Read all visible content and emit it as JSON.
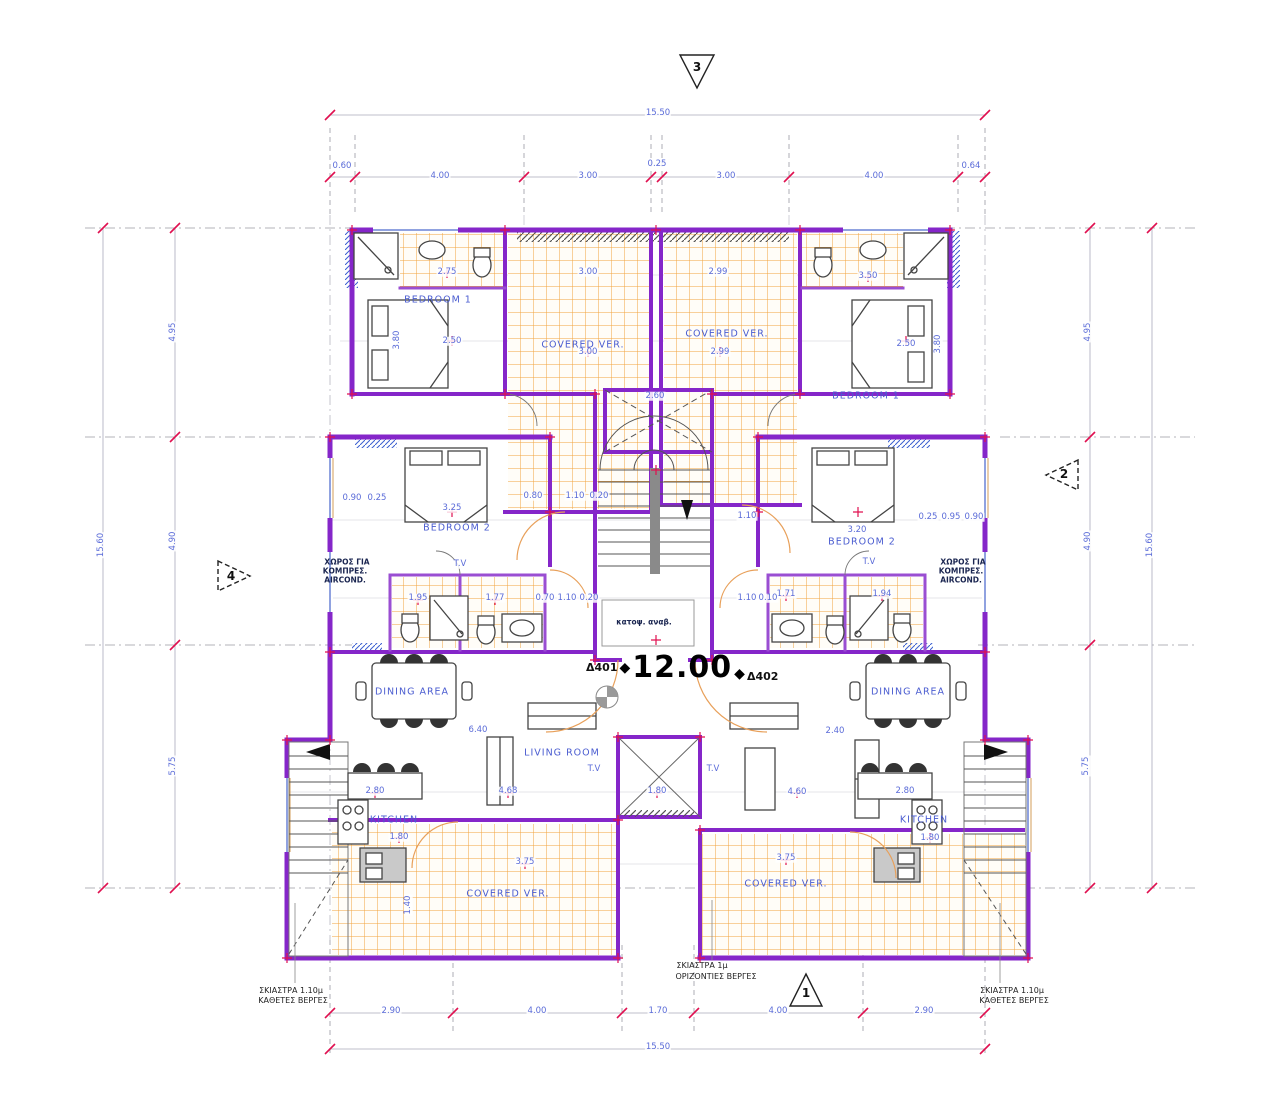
{
  "level": {
    "left": "Δ401",
    "value": "12.00",
    "right": "Δ402"
  },
  "markers": [
    {
      "id": "3",
      "position": "top"
    },
    {
      "id": "1",
      "position": "bottom"
    },
    {
      "id": "2",
      "position": "right"
    },
    {
      "id": "4",
      "position": "left"
    }
  ],
  "dimension_chains": {
    "top": {
      "overall": "15.50",
      "segments": [
        "0.60",
        "4.00",
        "3.00",
        "0.25",
        "3.00",
        "4.00",
        "0.64"
      ]
    },
    "bottom": {
      "overall": "15.50",
      "segments": [
        "2.90",
        "4.00",
        "1.70",
        "4.00",
        "2.90"
      ]
    },
    "left": {
      "overall": "15.60",
      "segments": [
        "4.95",
        "4.90",
        "5.75"
      ]
    },
    "right": {
      "overall": "15.60",
      "segments": [
        "4.95",
        "4.90",
        "5.75"
      ]
    }
  },
  "colors": {
    "wall": "#8526c9",
    "tile": "#f2a43e",
    "dim_text": "#5a6bd8",
    "tick": "#e01050"
  },
  "labels": [
    {
      "t": "15.50",
      "x": 658,
      "y": 113,
      "n": "dim-top-overall"
    },
    {
      "t": "0.60",
      "x": 342,
      "y": 166
    },
    {
      "t": "4.00",
      "x": 440,
      "y": 176
    },
    {
      "t": "3.00",
      "x": 588,
      "y": 176
    },
    {
      "t": "0.25",
      "x": 657,
      "y": 164
    },
    {
      "t": "3.00",
      "x": 726,
      "y": 176
    },
    {
      "t": "4.00",
      "x": 874,
      "y": 176
    },
    {
      "t": "0.64",
      "x": 971,
      "y": 166
    },
    {
      "t": "2.90",
      "x": 391,
      "y": 1011
    },
    {
      "t": "4.00",
      "x": 537,
      "y": 1011
    },
    {
      "t": "1.70",
      "x": 658,
      "y": 1011
    },
    {
      "t": "4.00",
      "x": 778,
      "y": 1011
    },
    {
      "t": "2.90",
      "x": 924,
      "y": 1011
    },
    {
      "t": "15.50",
      "x": 658,
      "y": 1047,
      "n": "dim-bottom-overall"
    },
    {
      "t": "15.60",
      "x": 101,
      "y": 545,
      "r": 1,
      "n": "dim-left-overall"
    },
    {
      "t": "4.95",
      "x": 173,
      "y": 332,
      "r": 1
    },
    {
      "t": "4.90",
      "x": 173,
      "y": 541,
      "r": 1
    },
    {
      "t": "5.75",
      "x": 173,
      "y": 766,
      "r": 1
    },
    {
      "t": "4.95",
      "x": 1088,
      "y": 332,
      "r": 1
    },
    {
      "t": "4.90",
      "x": 1088,
      "y": 541,
      "r": 1
    },
    {
      "t": "5.75",
      "x": 1086,
      "y": 766,
      "r": 1
    },
    {
      "t": "15.60",
      "x": 1150,
      "y": 545,
      "r": 1,
      "n": "dim-right-overall"
    },
    {
      "t": "3",
      "x": 697,
      "y": 67,
      "c": "mk",
      "n": "section-marker-3-label"
    },
    {
      "t": "1",
      "x": 806,
      "y": 993,
      "c": "mk",
      "n": "section-marker-1-label"
    },
    {
      "t": "2",
      "x": 1064,
      "y": 474,
      "c": "mk",
      "n": "section-marker-2-label"
    },
    {
      "t": "4",
      "x": 231,
      "y": 576,
      "c": "mk",
      "n": "section-marker-4-label"
    },
    {
      "t": "BEDROOM 1",
      "x": 438,
      "y": 300,
      "c": "room",
      "n": "room-label-bedroom1-left"
    },
    {
      "t": "BEDROOM 1",
      "x": 866,
      "y": 396,
      "c": "room",
      "n": "room-label-bedroom1-right"
    },
    {
      "t": "COVERED VER.",
      "x": 583,
      "y": 345,
      "c": "room",
      "n": "room-label-covered-ver-top-left"
    },
    {
      "t": "COVERED VER.",
      "x": 727,
      "y": 334,
      "c": "room",
      "n": "room-label-covered-ver-top-right"
    },
    {
      "t": "BEDROOM 2",
      "x": 457,
      "y": 528,
      "c": "room",
      "n": "room-label-bedroom2-left"
    },
    {
      "t": "BEDROOM 2",
      "x": 862,
      "y": 542,
      "c": "room",
      "n": "room-label-bedroom2-right"
    },
    {
      "t": "DINING AREA",
      "x": 412,
      "y": 692,
      "c": "room",
      "n": "room-label-dining-left"
    },
    {
      "t": "DINING AREA",
      "x": 908,
      "y": 692,
      "c": "room",
      "n": "room-label-dining-right"
    },
    {
      "t": "LIVING ROOM",
      "x": 562,
      "y": 753,
      "c": "room",
      "n": "room-label-living"
    },
    {
      "t": "KITCHEN",
      "x": 394,
      "y": 820,
      "c": "room",
      "n": "room-label-kitchen-left"
    },
    {
      "t": "KITCHEN",
      "x": 924,
      "y": 820,
      "c": "room",
      "n": "room-label-kitchen-right"
    },
    {
      "t": "COVERED VER.",
      "x": 508,
      "y": 894,
      "c": "room",
      "n": "room-label-covered-ver-bottom-left"
    },
    {
      "t": "COVERED VER.",
      "x": 786,
      "y": 884,
      "c": "room",
      "n": "room-label-covered-ver-bottom-right"
    },
    {
      "t": "T.V",
      "x": 460,
      "y": 564
    },
    {
      "t": "T.V",
      "x": 869,
      "y": 562
    },
    {
      "t": "T.V",
      "x": 594,
      "y": 769
    },
    {
      "t": "T.V",
      "x": 713,
      "y": 769
    },
    {
      "t": "κατοψ. αναβ.",
      "x": 644,
      "y": 622,
      "c": "grk",
      "n": "stair-lobby-note"
    },
    {
      "t": "ΧΩΡΟΣ ΓΙΑ",
      "x": 347,
      "y": 562,
      "c": "grk"
    },
    {
      "t": "ΚΟΜΠΡΕΣ.",
      "x": 345,
      "y": 571,
      "c": "grk"
    },
    {
      "t": "AIRCOND.",
      "x": 345,
      "y": 580,
      "c": "grk"
    },
    {
      "t": "ΧΩΡΟΣ ΓΙΑ",
      "x": 963,
      "y": 562,
      "c": "grk"
    },
    {
      "t": "ΚΟΜΠΡΕΣ.",
      "x": 961,
      "y": 571,
      "c": "grk"
    },
    {
      "t": "AIRCOND.",
      "x": 961,
      "y": 580,
      "c": "grk"
    },
    {
      "t": "ΣΚΙΑΣΤΡΑ 1.10μ",
      "x": 291,
      "y": 991,
      "c": "note"
    },
    {
      "t": "ΚΑΘΕΤΕΣ ΒΕΡΓΕΣ",
      "x": 293,
      "y": 1001,
      "c": "note"
    },
    {
      "t": "ΣΚΙΑΣΤΡΑ 1μ",
      "x": 702,
      "y": 966,
      "c": "note"
    },
    {
      "t": "ΟΡΙΖΟΝΤΙΕΣ ΒΕΡΓΕΣ",
      "x": 716,
      "y": 977,
      "c": "note"
    },
    {
      "t": "ΣΚΙΑΣΤΡΑ 1.10μ",
      "x": 1012,
      "y": 991,
      "c": "note"
    },
    {
      "t": "ΚΑΘΕΤΕΣ ΒΕΡΓΕΣ",
      "x": 1014,
      "y": 1001,
      "c": "note"
    },
    {
      "t": "3.00",
      "x": 588,
      "y": 272
    },
    {
      "t": "2.99",
      "x": 718,
      "y": 272
    },
    {
      "t": "3.00",
      "x": 588,
      "y": 352
    },
    {
      "t": "2.99",
      "x": 720,
      "y": 352
    },
    {
      "t": "2.75",
      "x": 447,
      "y": 272
    },
    {
      "t": "3.50",
      "x": 868,
      "y": 276
    },
    {
      "t": "2.50",
      "x": 452,
      "y": 341
    },
    {
      "t": "2.50",
      "x": 906,
      "y": 344
    },
    {
      "t": "3.80",
      "x": 397,
      "y": 340,
      "r": 1
    },
    {
      "t": "3.80",
      "x": 938,
      "y": 344,
      "r": 1
    },
    {
      "t": "2.60",
      "x": 655,
      "y": 396
    },
    {
      "t": "0.90",
      "x": 352,
      "y": 498
    },
    {
      "t": "0.25",
      "x": 377,
      "y": 498
    },
    {
      "t": "3.25",
      "x": 452,
      "y": 508
    },
    {
      "t": "0.80",
      "x": 533,
      "y": 496
    },
    {
      "t": "1.10",
      "x": 575,
      "y": 496
    },
    {
      "t": "0.20",
      "x": 599,
      "y": 496
    },
    {
      "t": "1.10",
      "x": 747,
      "y": 516
    },
    {
      "t": "3.20",
      "x": 857,
      "y": 530
    },
    {
      "t": "0.25",
      "x": 928,
      "y": 517
    },
    {
      "t": "0.95",
      "x": 951,
      "y": 517
    },
    {
      "t": "0.90",
      "x": 974,
      "y": 517
    },
    {
      "t": "1.95",
      "x": 418,
      "y": 598
    },
    {
      "t": "1.77",
      "x": 495,
      "y": 598
    },
    {
      "t": "0.70",
      "x": 545,
      "y": 598
    },
    {
      "t": "1.10",
      "x": 567,
      "y": 598
    },
    {
      "t": "0.20",
      "x": 589,
      "y": 598
    },
    {
      "t": "1.71",
      "x": 786,
      "y": 594
    },
    {
      "t": "1.94",
      "x": 882,
      "y": 594
    },
    {
      "t": "1.10",
      "x": 747,
      "y": 598
    },
    {
      "t": "0.10",
      "x": 768,
      "y": 598
    },
    {
      "t": "2.80",
      "x": 375,
      "y": 791
    },
    {
      "t": "1.80",
      "x": 399,
      "y": 837
    },
    {
      "t": "4.68",
      "x": 508,
      "y": 791
    },
    {
      "t": "6.40",
      "x": 478,
      "y": 730
    },
    {
      "t": "3.75",
      "x": 525,
      "y": 862
    },
    {
      "t": "1.40",
      "x": 408,
      "y": 905,
      "r": 1
    },
    {
      "t": "1.80",
      "x": 657,
      "y": 791
    },
    {
      "t": "4.60",
      "x": 797,
      "y": 792
    },
    {
      "t": "2.40",
      "x": 835,
      "y": 731
    },
    {
      "t": "3.75",
      "x": 786,
      "y": 858
    },
    {
      "t": "1.80",
      "x": 930,
      "y": 838
    },
    {
      "t": "2.80",
      "x": 905,
      "y": 791
    }
  ]
}
